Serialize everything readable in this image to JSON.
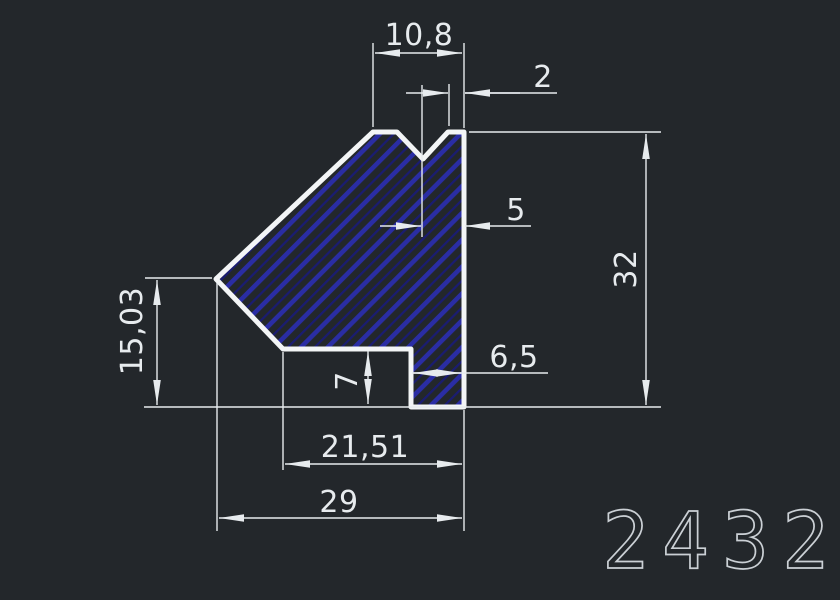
{
  "drawing": {
    "part_number": "2432",
    "dimensions": {
      "top_width": "10,8",
      "notch_right_offset": "2",
      "notch_center_to_edge": "5",
      "total_height": "32",
      "left_side_height": "15,03",
      "foot_height": "7",
      "foot_width": "6,5",
      "bottom_inner_width": "21,51",
      "total_width": "29"
    },
    "colors": {
      "background": "#23272b",
      "outline": "#f3f5f6",
      "dimension": "#e7ebee",
      "hatch_primary": "#2a2da4",
      "hatch_secondary": "#1a1c72",
      "part_number_color": "#cbd0d5"
    }
  }
}
